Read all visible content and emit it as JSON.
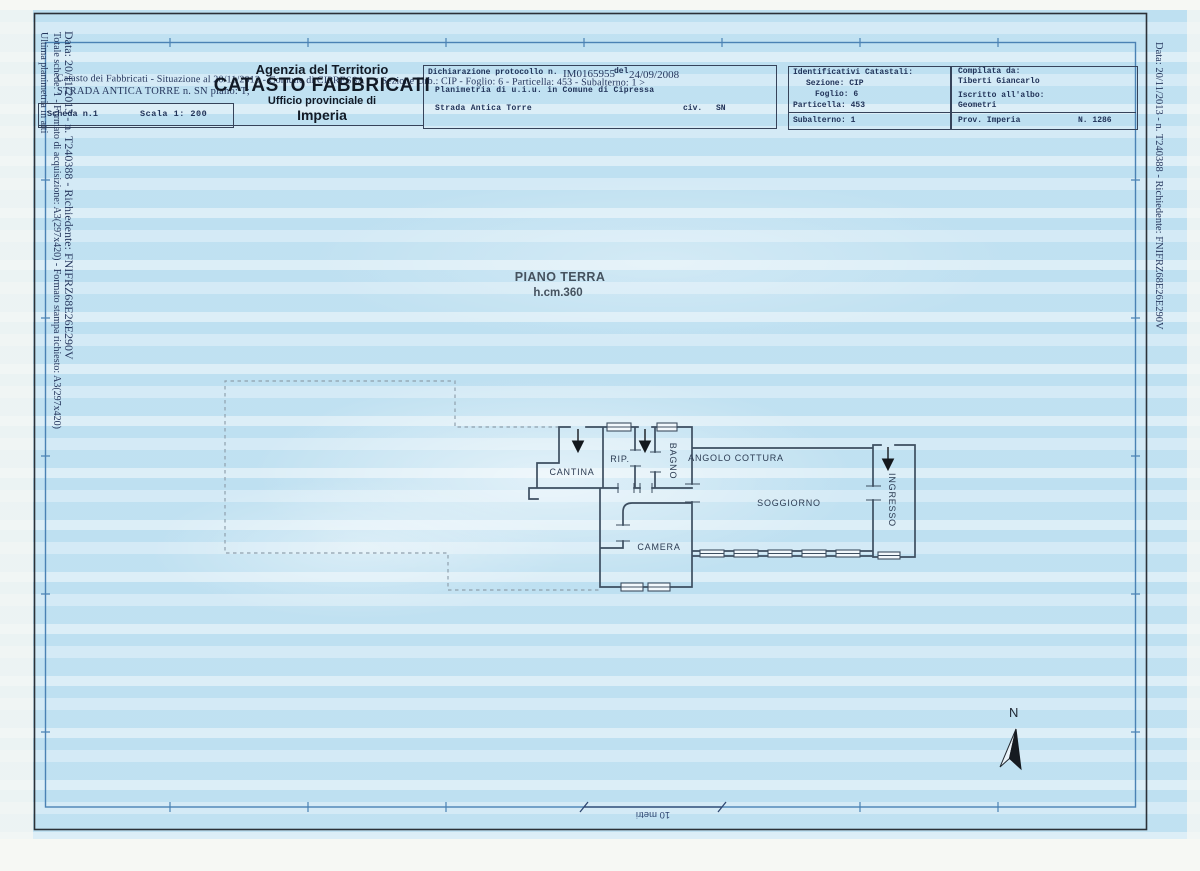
{
  "colors": {
    "paper_blue": "#cde7f4",
    "frame_blue": "#4a82b4",
    "wall": "#3d4e60",
    "ink_navy": "#203258"
  },
  "margin_notes": {
    "left_line1": "Data: 20/11/2013 - n. T240388 - Richiedente: FNIFRZ68E26E290V",
    "left_line2": "Totale schede: 1 - Formato di acquisizione: A3(297x420) - Formato stampa richiesto: A3(297x420)",
    "left_line3": "Ultima planimetria in atti",
    "right_line1": "Data: 20/11/2013 - n. T240388 - Richiedente: FNIFRZ68E26E290V"
  },
  "header": {
    "agency": "Agenzia del Territorio",
    "registry": "CATASTO FABBRICATI",
    "office": "Ufficio provinciale di",
    "province": "Imperia",
    "situation_line": "Catasto dei Fabbricati - Situazione al 20/11/2013 - Comune di CIPRESSA - < Sezione Urb.: CIP - Foglio: 6 - Particella: 453 - Subalterno: 1 >",
    "address_line": "STRADA ANTICA TORRE n. SN piano: T;",
    "sheet_label": "Scheda n.1",
    "scale_label": "Scala 1: 200"
  },
  "declaration": {
    "protocol_label": "Dichiarazione protocollo n.",
    "protocol_number": "IM0165955",
    "del_label": "del",
    "protocol_date": "24/09/2008",
    "planimetry_line": "Planimetria di u.i.u. in Comune di Cipressa",
    "street": "Strada Antica Torre",
    "civ_label": "civ.",
    "civ_value": "SN"
  },
  "cadastral_ids": {
    "title": "Identificativi Catastali:",
    "sezione": "Sezione: CIP",
    "foglio": "Foglio: 6",
    "particella": "Particella: 453",
    "subalterno": "Subalterno: 1"
  },
  "compiler": {
    "title": "Compilata da:",
    "name": "Tiberti Giancarlo",
    "register_label": "Iscritto all'albo:",
    "register": "Geometri",
    "province": "Prov. Imperia",
    "number": "N. 1286"
  },
  "plan": {
    "floor_title": "PIANO TERRA",
    "floor_height": "h.cm.360",
    "rooms": {
      "cantina": "CANTINA",
      "rip": "RIP.",
      "bagno": "BAGNO",
      "angolo_cottura": "ANGOLO COTTURA",
      "soggiorno": "SOGGIORNO",
      "ingresso": "INGRESSO",
      "camera": "CAMERA"
    },
    "north_label": "N",
    "scale_bar_label": "10 metri"
  }
}
